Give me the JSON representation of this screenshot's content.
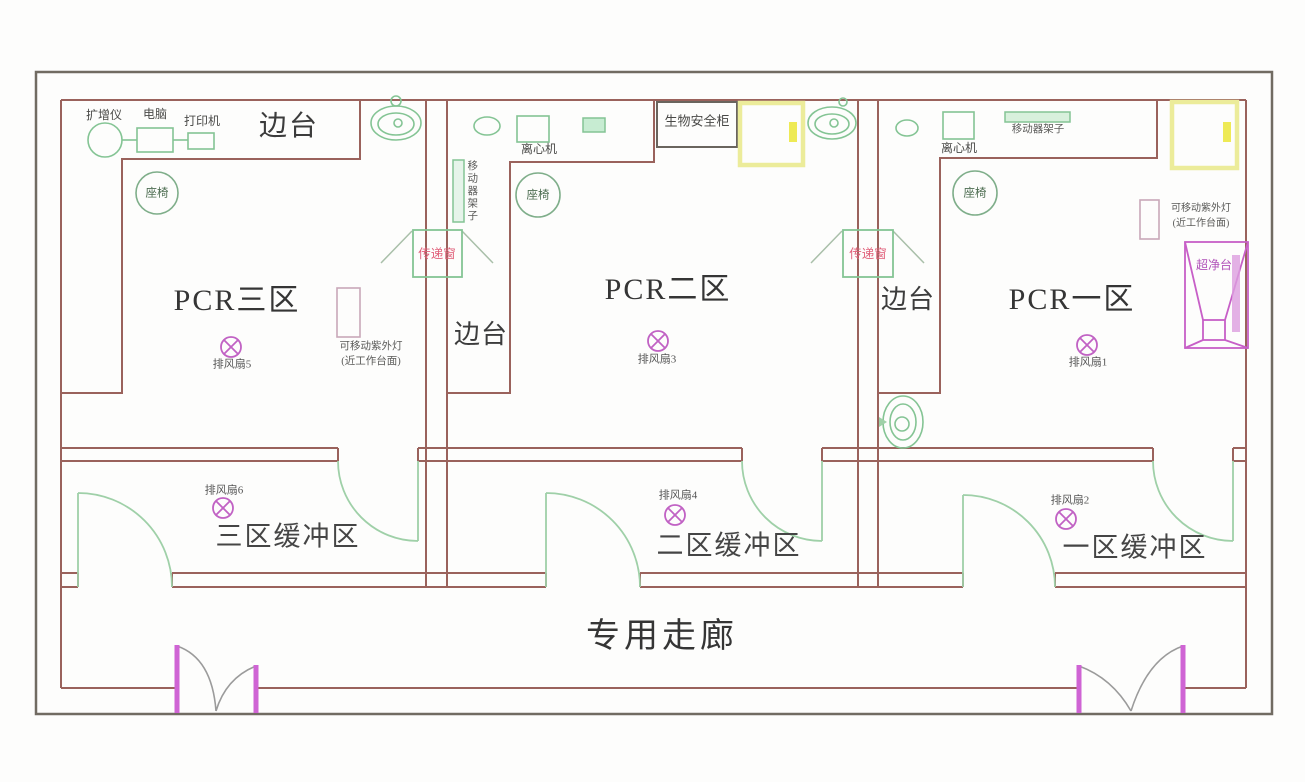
{
  "plan": {
    "rooms": {
      "zone3": {
        "title": "PCR三区",
        "bench": "边台",
        "chair": "座椅",
        "amplifier": "扩增仪",
        "computer": "电脑",
        "printer": "打印机",
        "fan": "排风扇5",
        "uv_line1": "可移动紫外灯",
        "uv_line2": "(近工作台面)"
      },
      "zone2": {
        "title": "PCR二区",
        "bench": "边台",
        "chair": "座椅",
        "centrifuge": "离心机",
        "rack": "移动器架子",
        "biosafety": "生物安全柜",
        "fan": "排风扇3"
      },
      "zone1": {
        "title": "PCR一区",
        "bench": "边台",
        "chair": "座椅",
        "centrifuge": "离心机",
        "rack": "移动器架子",
        "clean_bench": "超净台",
        "uv_line1": "可移动紫外灯",
        "uv_line2": "(近工作台面)",
        "fan": "排风扇1"
      }
    },
    "pass_windows": {
      "left": "传递窗",
      "right": "传递窗"
    },
    "buffers": {
      "zone3": {
        "title": "三区缓冲区",
        "fan": "排风扇6"
      },
      "zone2": {
        "title": "二区缓冲区",
        "fan": "排风扇4"
      },
      "zone1": {
        "title": "一区缓冲区",
        "fan": "排风扇2"
      }
    },
    "corridor": "专用走廊",
    "colors": {
      "wall_red": "#9a625c",
      "outer_frame": "#716b62",
      "equipment_green": "#84c494",
      "door_green": "#9fd0a8",
      "fan_magenta": "#c162c4",
      "pass_window_text": "#e0607a",
      "clean_bench_magenta": "#c75fc7",
      "door_jamb_magenta": "#cf64d4",
      "highlight_yellow": "#ecec9a"
    }
  }
}
